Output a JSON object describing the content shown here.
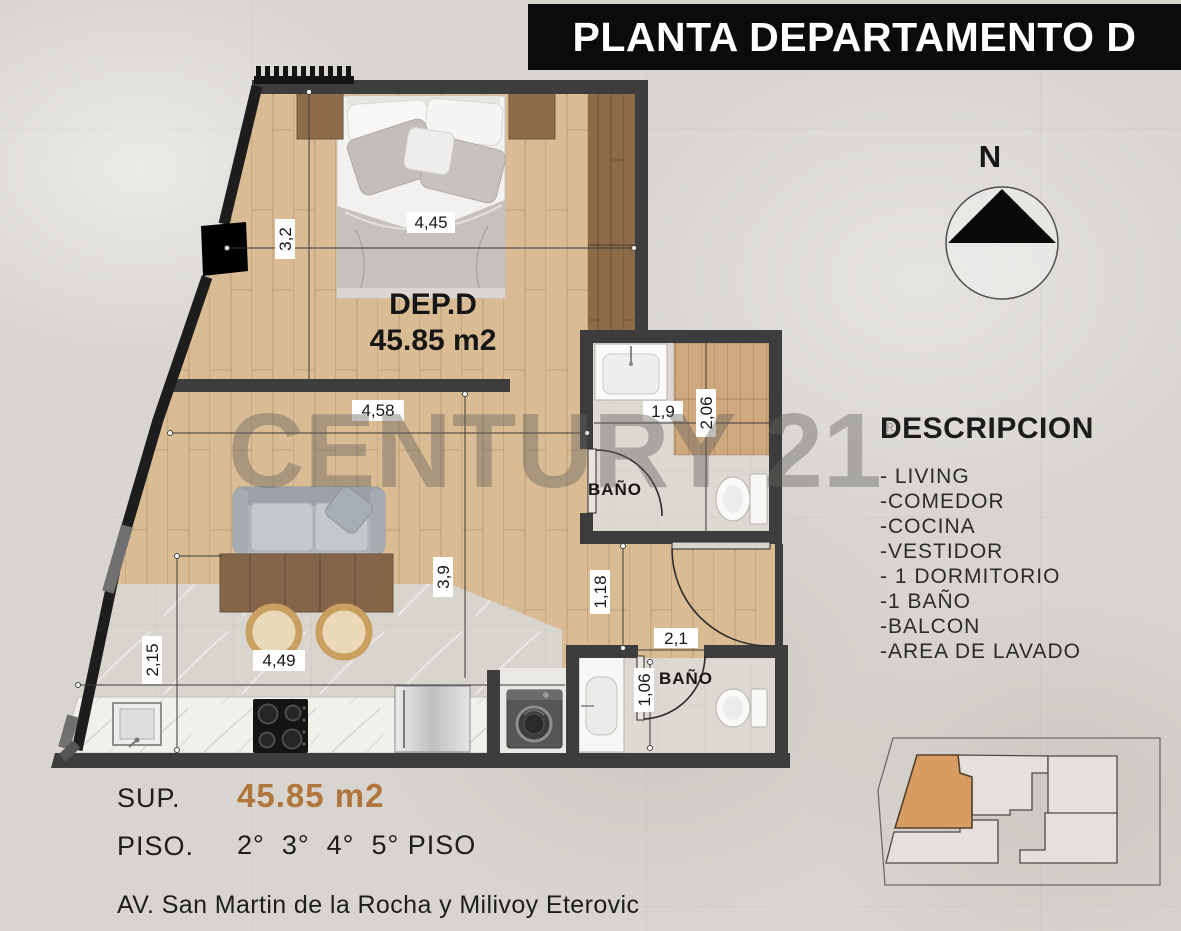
{
  "title": "PLANTA DEPARTAMENTO D",
  "compass": {
    "north_label": "N"
  },
  "watermark": {
    "text": "CENTURY 21",
    "registered_mark": "®"
  },
  "plan": {
    "unit_name": "DEP.D",
    "unit_area": "45.85 m2",
    "bath1_label": "BAÑO",
    "bath2_label": "BAÑO",
    "dims": {
      "bedroom_width": "4,45",
      "bedroom_height": "3,2",
      "living_width": "4,58",
      "bath1_width": "1,9",
      "bath1_height": "2,06",
      "living_height": "3,9",
      "hall_height": "1,18",
      "bath2_width": "2,1",
      "bath2_height": "1,06",
      "kitchen_height": "2,15",
      "kitchen_width": "4,49"
    }
  },
  "description": {
    "heading": "DESCRIPCION",
    "items": [
      "- LIVING",
      "-COMEDOR",
      "-COCINA",
      "-VESTIDOR",
      "- 1 DORMITORIO",
      "-1 BAÑO",
      "-BALCON",
      "-AREA DE LAVADO"
    ]
  },
  "summary": {
    "sup_label": "SUP.",
    "sup_value": "45.85 m2",
    "piso_label": "PISO.",
    "piso_value": "2°  3°  4°  5° PISO"
  },
  "address": "AV. San Martin de la Rocha y Milivoy Eterovic",
  "colors": {
    "accent_orange": "#b0763c",
    "banner_bg": "#0b0b0b",
    "keyplan_highlight": "#d89b61",
    "wall": "#3d3d3d",
    "wood_floor": "#d9bc93"
  }
}
